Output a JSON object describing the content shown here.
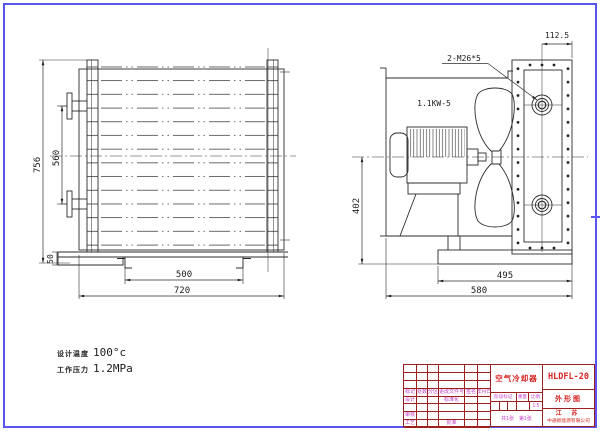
{
  "colors": {
    "frame_border": "#5a55ee",
    "title_block_line": "#9b1f1f",
    "title_block_text_red": "#d82323",
    "title_block_text_magenta": "#c23ac2",
    "linework": "#2b2b2b"
  },
  "front_view": {
    "dim_overall_height": "756",
    "dim_port_spacing": "560",
    "dim_base_height": "50",
    "dim_foot_spacing": "500",
    "dim_overall_width": "720"
  },
  "side_view": {
    "motor_label": "1.1KW-5",
    "thread_note": "2-M26*5",
    "dim_port_offset": "112.5",
    "dim_axis_height": "402",
    "dim_base_width": "495",
    "dim_overall_depth": "580"
  },
  "specs": {
    "design_temp_label": "设计温度",
    "design_temp_value": "100°c",
    "work_pressure_label": "工作压力",
    "work_pressure_value": "1.2MPa"
  },
  "title_block": {
    "product_name": "空气冷却器",
    "model": "HLDFL-20",
    "sheet_name": "外形图",
    "region": "江 苏",
    "company": "中通新能源有限公司",
    "rev_headers": [
      "标记",
      "处数",
      "分区",
      "更改文件号",
      "签名",
      "年月日"
    ],
    "roles": {
      "design": "设计",
      "standardize": "标准化",
      "review": "审核",
      "process": "工艺",
      "approve": "批准"
    },
    "stage_label": "阶段标记",
    "weight_label": "重量",
    "scale_label": "比例",
    "scale_value": "1:5",
    "sheets_total": "共1张",
    "sheet_index": "第1张"
  }
}
